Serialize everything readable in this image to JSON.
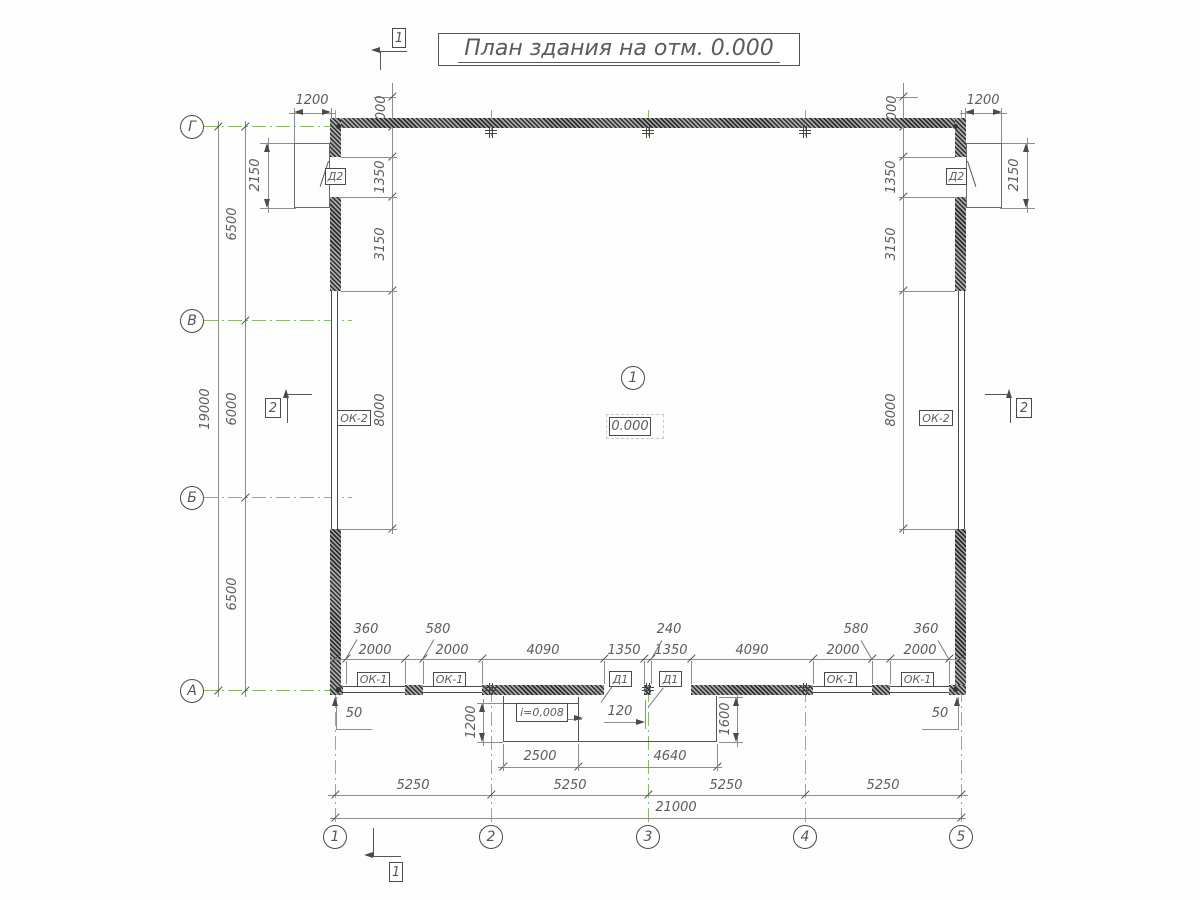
{
  "title": {
    "text": "План здания на отм. 0.000"
  },
  "axes": {
    "g": "Г",
    "v": "В",
    "b": "Б",
    "a": "А",
    "n1": "1",
    "n2": "2",
    "n3": "3",
    "n4": "4",
    "n5": "5"
  },
  "sections": {
    "s1": "1",
    "s2": "2"
  },
  "callouts": {
    "door1": "Д1",
    "door2": "Д2",
    "window1": "ОК-1",
    "window2": "ОК-2",
    "level": "0.000",
    "slope": "i=0,008",
    "room": "1"
  },
  "dims": {
    "d19000": "19000",
    "d6500": "6500",
    "d6000": "6000",
    "d2150": "2150",
    "d1200": "1200",
    "d1000": "1000",
    "d1350": "1350",
    "d3150": "3150",
    "d8000": "8000",
    "d2000": "2000",
    "d4090": "4090",
    "d360": "360",
    "d580": "580",
    "d240": "240",
    "d120": "120",
    "d50": "50",
    "d1600": "1600",
    "d2500": "2500",
    "d4640": "4640",
    "d5250": "5250",
    "d21000": "21000"
  },
  "colors": {
    "axis_green": "#86bb6a",
    "line_gray": "#8d8d8d",
    "wall_dark": "#2e2e2e"
  }
}
